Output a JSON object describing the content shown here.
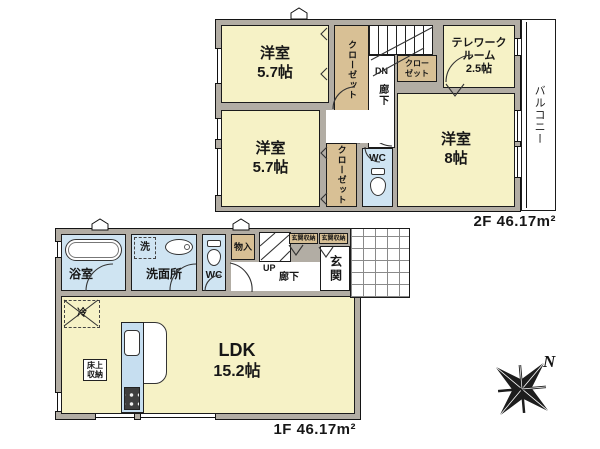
{
  "floor2": {
    "area_label": "2F 46.17m²",
    "room_west_top": {
      "name": "洋室",
      "size": "5.7帖"
    },
    "room_west_bottom": {
      "name": "洋室",
      "size": "5.7帖"
    },
    "room_east": {
      "name": "洋室",
      "size": "8帖"
    },
    "telework": {
      "name_line1": "テレワーク",
      "name_line2": "ルーム",
      "size": "2.5帖"
    },
    "closet_north": "クローゼット",
    "closet_stair_line1": "クロー",
    "closet_stair_line2": "ゼット",
    "closet_mid": "クローゼット",
    "wc": "WC",
    "dn": "DN",
    "hallway": "廊下",
    "balcony": "バルコニー"
  },
  "floor1": {
    "area_label": "1F 46.17m²",
    "bath": "浴室",
    "washer": "洗",
    "washroom": "洗面所",
    "wc": "WC",
    "storage": "物入",
    "up": "UP",
    "hallway": "廊下",
    "entrance_storage_a": "玄関収納",
    "entrance_storage_b": "玄関収納",
    "entrance": "玄関",
    "ldk": {
      "name": "LDK",
      "size": "15.2帖"
    },
    "fridge": "冷",
    "floor_storage_line1": "床上",
    "floor_storage_line2": "収納"
  },
  "compass": {
    "north": "N"
  },
  "colors": {
    "room": "#f6f2c6",
    "closet": "#d8c095",
    "wet": "#cfe4f2",
    "wall": "#b2ada4"
  }
}
